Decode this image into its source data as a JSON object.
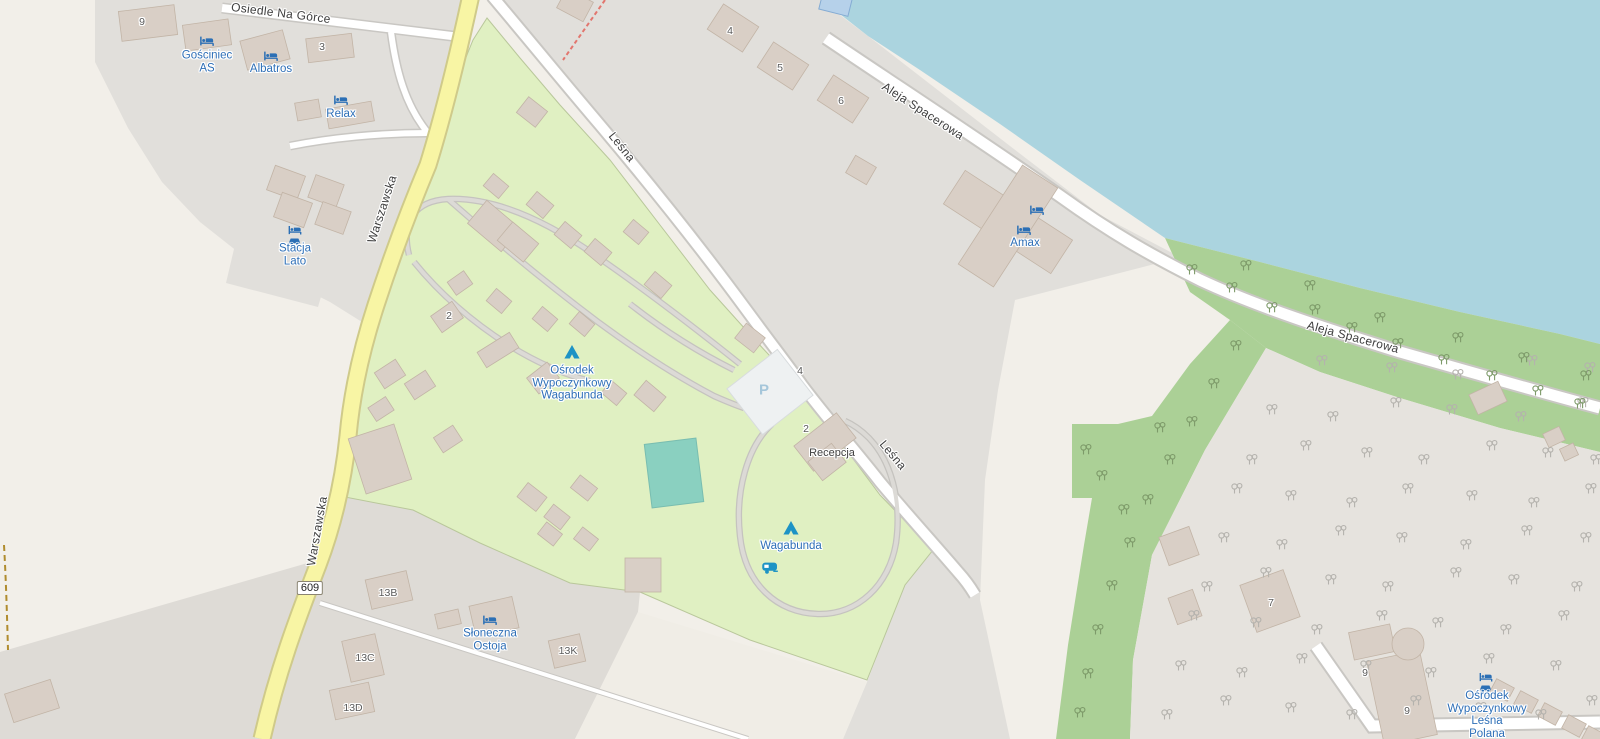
{
  "viewport": {
    "kind": "openstreetmap map view",
    "width_px": 1600,
    "height_px": 739
  },
  "roads": {
    "osiedle_na_gorce": "Osiedle Na Górce",
    "warszawska_1": "Warszawska",
    "warszawska_2": "Warszawska",
    "route_badge": "609",
    "lesna_1": "Leśna",
    "lesna_2": "Leśna",
    "aleja_spacerowa_1": "Aleja Spacerowa",
    "aleja_spacerowa_2": "Aleja Spacerowa"
  },
  "pois": {
    "gosciniec_as": {
      "lines": [
        "Gościniec",
        "AS"
      ],
      "icon": "bed-icon"
    },
    "albatros": {
      "label": "Albatros",
      "icon": "bed-icon"
    },
    "relax": {
      "label": "Relax",
      "icon": "bed-icon"
    },
    "stacja_lato": {
      "lines": [
        "Stacja",
        "Lato"
      ],
      "icon": "bed-icon + car-icon"
    },
    "amax": {
      "label": "Amax",
      "icon": "bed-icon x2"
    },
    "wagabunda_resort": {
      "lines": [
        "Ośrodek",
        "Wypoczynkowy",
        "Wagabunda"
      ],
      "icon": "tent-icon"
    },
    "wagabunda_camp": {
      "label": "Wagabunda",
      "icon": "tent-icon + caravan-icon"
    },
    "recepcja": {
      "label": "Recepcja"
    },
    "parking": {
      "label": "P"
    },
    "sloneczna_ostoja": {
      "lines": [
        "Słoneczna",
        "Ostoja"
      ],
      "icon": "bed-icon"
    },
    "lesna_polana": {
      "lines": [
        "Ośrodek",
        "Wypoczynkowy",
        "Leśna",
        "Polana"
      ],
      "icon": "bed-icon + car-icon"
    }
  },
  "housenumbers": [
    {
      "text": "9"
    },
    {
      "text": "3"
    },
    {
      "text": "4"
    },
    {
      "text": "5"
    },
    {
      "text": "6"
    },
    {
      "text": "2"
    },
    {
      "text": "4"
    },
    {
      "text": "2"
    },
    {
      "text": "13B"
    },
    {
      "text": "13C"
    },
    {
      "text": "13K"
    },
    {
      "text": "13D"
    },
    {
      "text": "7"
    },
    {
      "text": "9"
    },
    {
      "text": "9"
    }
  ],
  "colors": {
    "water": "#abd4df",
    "campsite_green": "#e0f0c2",
    "forest_green": "#abd096",
    "wooded_gray": "#e6e3de",
    "residential_gray": "#e1dfdb",
    "open_cream": "#f2efe9",
    "road_yellow": "#f8f5a4",
    "road_white": "#ffffff",
    "building": "#d9cfc6",
    "pool_teal": "#8ad0c0",
    "poi_text_blue": "#2e6fb7",
    "icon_blue": "#1d93c5",
    "trail_red_dashed": "#e2766e",
    "path_gold_dashed": "#b08c2e"
  }
}
